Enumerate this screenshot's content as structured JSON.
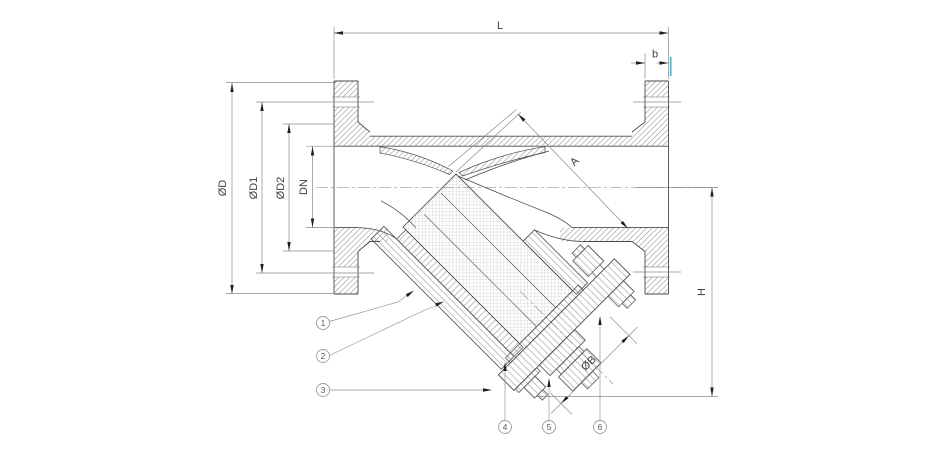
{
  "drawing": {
    "title": "Y-strainer sectional drawing",
    "colors": {
      "background": "#ffffff",
      "outline": "#4a4a4a",
      "hatch": "#8f8f8f",
      "dimension_line": "#8a8a8a",
      "dimension_text": "#3f3f3f",
      "arrow": "#1f1f1f",
      "callout_circle": "#9c9c9c",
      "highlight_tick": "#55b7c8"
    },
    "dimensions": {
      "face_to_face": "L",
      "flange_thickness": "b",
      "flange_outside_diameter": "ØD",
      "bolt_circle_diameter": "ØD1",
      "raised_face_diameter": "ØD2",
      "nominal_bore": "DN",
      "screen_axis_length": "A",
      "centerline_to_bottom": "H",
      "cover_diameter": "ØB"
    },
    "callouts": [
      {
        "id": "1"
      },
      {
        "id": "2"
      },
      {
        "id": "3"
      },
      {
        "id": "4"
      },
      {
        "id": "5"
      },
      {
        "id": "6"
      }
    ]
  }
}
